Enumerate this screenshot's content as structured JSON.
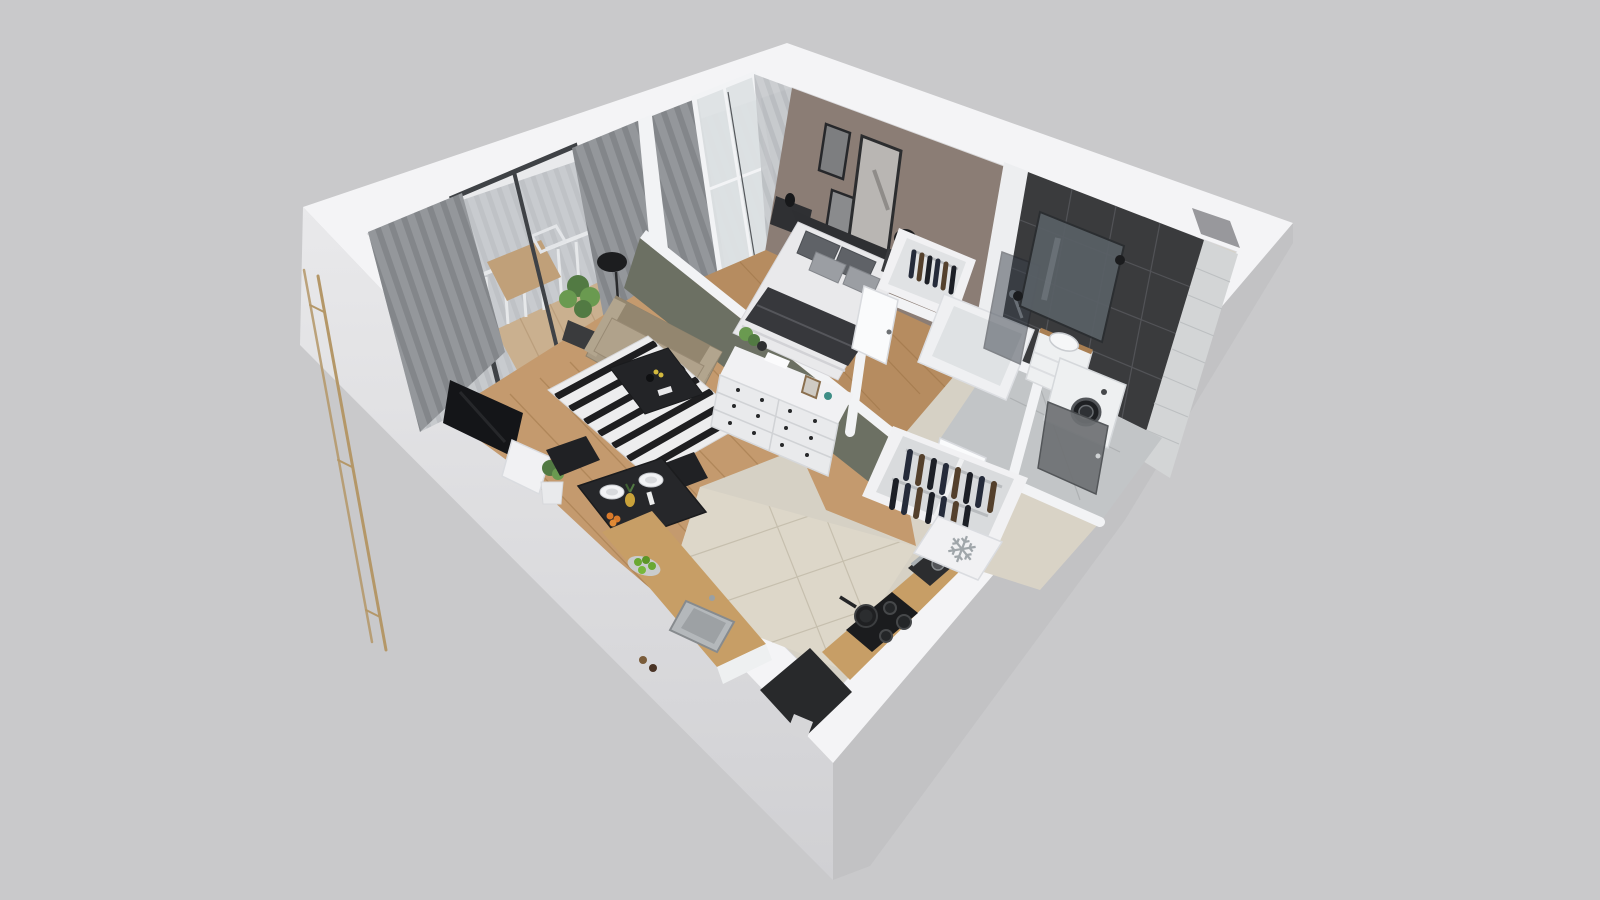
{
  "meta": {
    "kind": "3d-isometric-floorplan-render",
    "apartment": "one-bedroom-apartment"
  },
  "icons": {
    "freezer": "❄"
  },
  "palette": {
    "bg": "#c9c9cb",
    "ext-light-a": "#e9e9eb",
    "ext-light-b": "#d0d0d3",
    "ext-dark": "#c2c2c4",
    "rim": "#f4f4f6",
    "rim-edge": "#d8d8dc",
    "underlay": "#d6d1c5",
    "wood-living": "#c49a6e",
    "wood-bed": "#b68c60",
    "wood-deck": "#c9a475",
    "plank-line": "#9c7446",
    "tile-beige": "#ddd7c9",
    "tile-line": "#c6bfae",
    "hall-beige": "#d9d3c6",
    "bath-floor": "#c2c5c7",
    "taupe-wall": "#8b7d75",
    "olive-wall": "#6c7063",
    "wall-cap": "#f2f3f5",
    "dark-tile": "#3a3b3d",
    "grout": "#55565a",
    "light-tile": "#d3d5d6",
    "light-tile-line": "#bcbfc1",
    "curtain-a": "#94979b",
    "curtain-b": "#83868a",
    "sheer-a": "#c7cacd",
    "sheer-b": "#babdc1",
    "glass": "#ccd0d3",
    "frame-dark": "#3f4246",
    "window-white": "#f2f3f5",
    "sofa": "#a79a84",
    "sofa-dark": "#93866f",
    "sofa-light": "#b2a58e",
    "rug-white": "#ededee",
    "rug-black": "#1e1e20",
    "table-black": "#26272a",
    "chair-black": "#202124",
    "white-furn": "#f1f1f3",
    "white-furn-face": "#e9eaec",
    "furn-stroke": "#d6d8db",
    "bed-white": "#e9e9eb",
    "headboard": "#2e2f32",
    "pillow-dark": "#5f6267",
    "pillow-light": "#9b9ea3",
    "throw-dark": "#37383c",
    "counter-wood": "#c79e66",
    "steel": "#b4b8bb",
    "steel-dark": "#9da1a4",
    "cooktop": "#1b1c1e",
    "appliance-dark": "#2c2d2f",
    "fridge": "#f1f1f3",
    "snowflake": "#a0a6aa",
    "clothes-navy": "#252b3a",
    "clothes-brown": "#54402c",
    "clothes-black": "#1c1f26",
    "plant-green": "#527a43",
    "plant-green-2": "#6a9a50",
    "pot-dark": "#3a3b3d",
    "brass": "#b49768",
    "entrance-dark": "#28292b",
    "step-light": "#d6d6d8",
    "mirror": "#596066",
    "tv-black": "#141518",
    "door-white": "#fafbfc",
    "washer-door": "#1e2023"
  },
  "scene": {
    "rooms": [
      {
        "name": "balcony",
        "items": [
          "glass-sliding-door",
          "curtains",
          "deck",
          "railing",
          "bistro-table",
          "chairs"
        ]
      },
      {
        "name": "living-room",
        "items": [
          "sofa",
          "striped-rug",
          "coffee-table",
          "tv",
          "dresser",
          "floor-lamp",
          "potted-plant",
          "curtains"
        ]
      },
      {
        "name": "dining-area",
        "items": [
          "dining-table",
          "two-chairs",
          "plates",
          "fruit",
          "lime-bowl"
        ]
      },
      {
        "name": "kitchen",
        "items": [
          "counter",
          "sink",
          "cooktop",
          "frying-pan",
          "coffee-machine",
          "fridge-with-snowflake"
        ]
      },
      {
        "name": "bedroom",
        "items": [
          "double-bed",
          "pillows",
          "throw-blanket",
          "nightstand",
          "table-lamp",
          "wall-art",
          "open-wardrobe",
          "window"
        ]
      },
      {
        "name": "bathroom",
        "items": [
          "bathtub",
          "shower-glass",
          "mirror",
          "sconces",
          "vanity-sink",
          "washing-machine",
          "dark-tile-wall"
        ]
      },
      {
        "name": "hallway",
        "items": [
          "open-closet-with-clothes",
          "doors",
          "fridge-top"
        ]
      },
      {
        "name": "entrance",
        "items": [
          "dark-doormat",
          "step"
        ]
      }
    ]
  }
}
